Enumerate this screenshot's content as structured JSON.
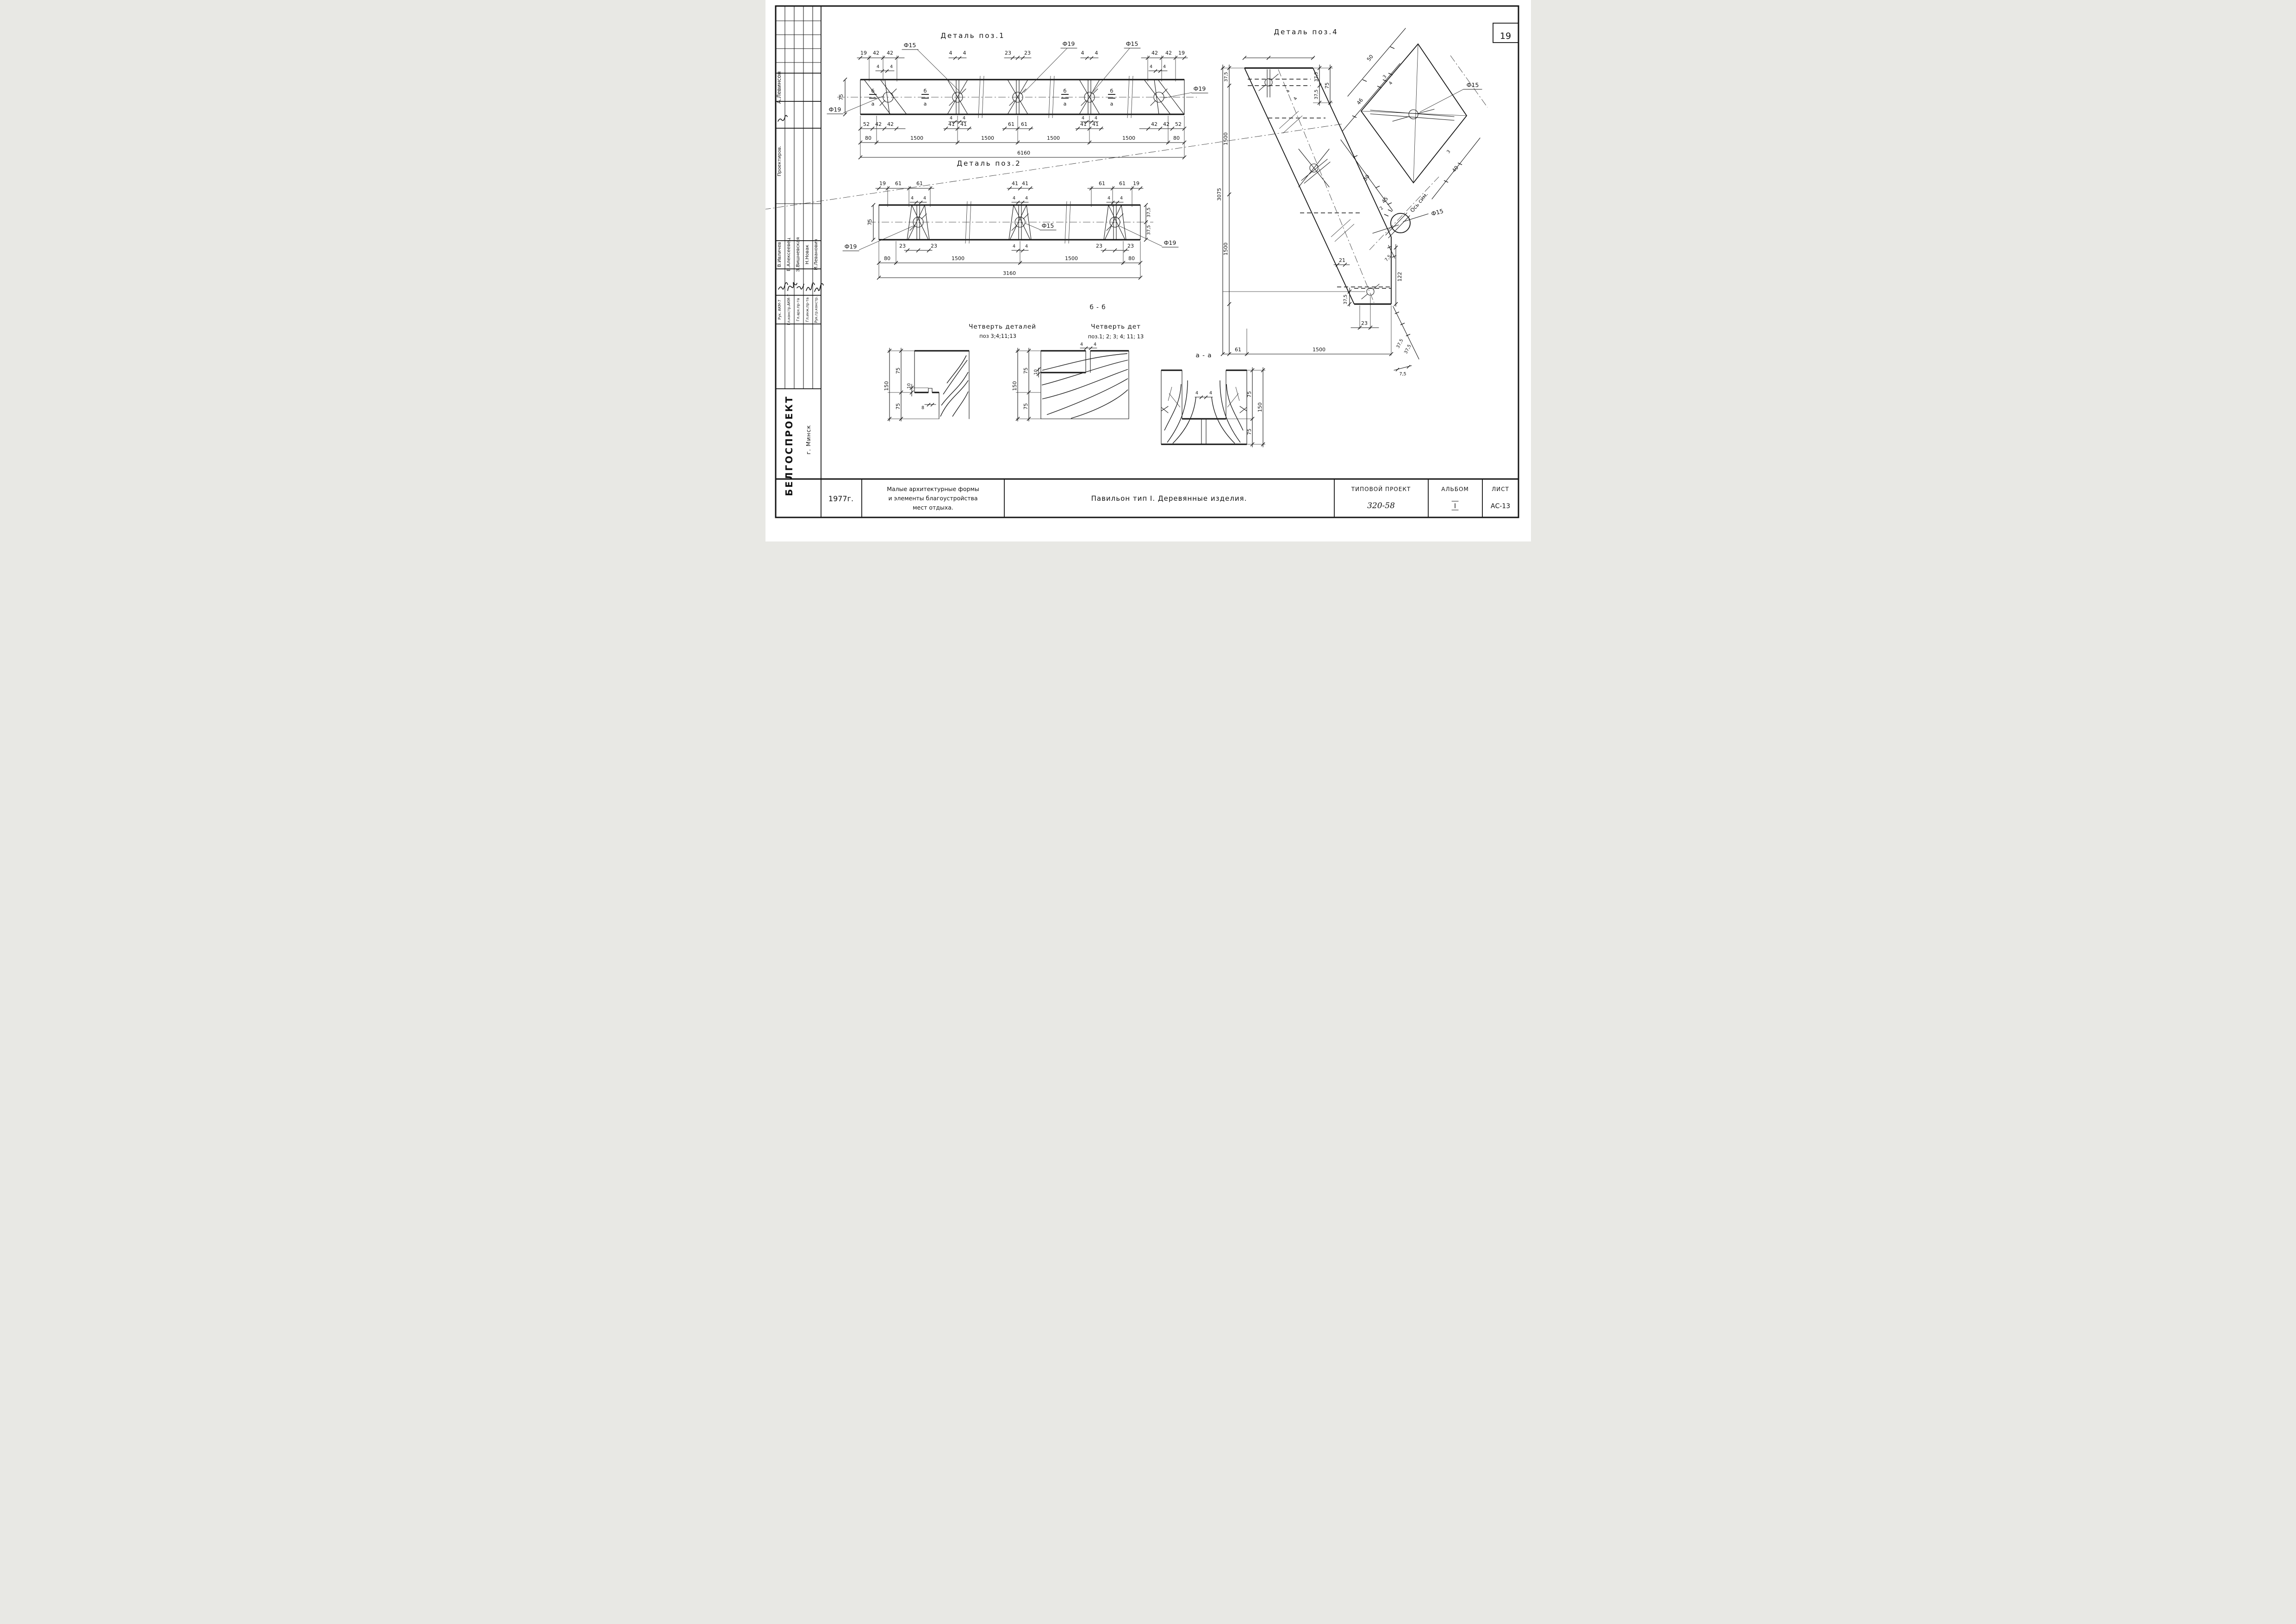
{
  "sheet": {
    "number": "19"
  },
  "titles": {
    "poz1": "Деталь поз.1",
    "poz2": "Деталь поз.2",
    "poz4": "Деталь поз.4",
    "bb": "б - б",
    "aa": "а - а",
    "q1a": "Четверть деталей",
    "q1b": "поз 3;4;11;13",
    "q2a": "Четверть дет",
    "q2b": "поз.1; 2; 3; 4; 11; 13"
  },
  "sidebar": {
    "top": {
      "name": "А.Левинсон",
      "role": "Проектиров."
    },
    "people": [
      {
        "name": "В.Ивличев",
        "role": "Рук. АКМ-7"
      },
      {
        "name": "В.Алексеевец",
        "role": "Гл.констр.АКМ-7"
      },
      {
        "name": "Э.Вишневская",
        "role": "Гл.арх.пр-та"
      },
      {
        "name": "Н.Новак",
        "role": "Гл.инж.пр-та"
      },
      {
        "name": "И.Леванович",
        "role": "Рук.гр.констр."
      }
    ]
  },
  "stamp": {
    "org": "БЕЛГОСПРОЕКТ",
    "city": "г. Минск",
    "year": "1977г.",
    "desc1": "Малые архитектурные формы",
    "desc2": "и элементы благоустройства",
    "desc3": "мест отдыха.",
    "title": "Павильон тип I.  Деревянные изделия.",
    "tp_label": "ТИПОВОЙ ПРОЕКТ",
    "tp_num": "320-58",
    "album_label": "АЛЬБОМ",
    "album_num": "I",
    "sheet_label": "ЛИСТ",
    "sheet_num": "АС-13"
  },
  "dims": {
    "poz1": {
      "tl": [
        "19",
        "42",
        "42"
      ],
      "tl4": [
        "4",
        "4"
      ],
      "b2t": [
        "4",
        "4"
      ],
      "b3t": [
        "23",
        "23"
      ],
      "b4t": [
        "4",
        "4"
      ],
      "tr": [
        "42",
        "42",
        "19"
      ],
      "tr4": [
        "4",
        "4"
      ],
      "b2b4": [
        "4",
        "4"
      ],
      "b4b4": [
        "4",
        "4"
      ],
      "r1l": [
        "52",
        "42",
        "42"
      ],
      "r1b2": [
        "41",
        "41"
      ],
      "r1b3": [
        "61",
        "61"
      ],
      "r1b4": [
        "41",
        "41"
      ],
      "r1r": [
        "42",
        "42",
        "52"
      ],
      "r2": [
        "80",
        "1500",
        "1500",
        "1500",
        "1500",
        "80"
      ],
      "total": "6160",
      "h": "75",
      "phi15a": "Ф15",
      "phi19a": "Ф19",
      "phi15b": "Ф15",
      "phi19bl": "Ф19",
      "phi19r": "Ф19",
      "b": "б",
      "a": "а"
    },
    "poz2": {
      "tl": [
        "19",
        "61",
        "61"
      ],
      "mid": [
        "41",
        "41"
      ],
      "tr": [
        "61",
        "61",
        "19"
      ],
      "s4": [
        "4",
        "4"
      ],
      "h": "75",
      "r375": [
        "37,5",
        "37,5"
      ],
      "b23l": [
        "23",
        "23"
      ],
      "b23r": [
        "23",
        "23"
      ],
      "r2": [
        "80",
        "1500",
        "1500",
        "80"
      ],
      "total": "3160",
      "phi15": "Ф15",
      "phi19bl": "Ф19",
      "phi19r": "Ф19"
    },
    "poz4": {
      "vchain": [
        "37,5",
        "1500",
        "1500"
      ],
      "vtotal": "3075",
      "tr": [
        "37,5",
        "37,5",
        "75"
      ],
      "t4": [
        "4",
        "4"
      ],
      "d122": "122",
      "d375": "37,5",
      "d23": "23",
      "d21": "21",
      "brow": [
        "61",
        "1500"
      ],
      "brot": [
        "37,5",
        "37,5"
      ],
      "d75": "7,5",
      "sq": {
        "d50": "50",
        "d46": "46",
        "d3a": "3",
        "d4a": "4",
        "d3b": "3",
        "d40": "40",
        "d30": "30",
        "d45": "45",
        "phi15": "Ф15"
      },
      "circ": {
        "axis": "Ось сим.",
        "phi15": "Ф15",
        "d2": "2",
        "d75": "7,5"
      }
    },
    "q1": [
      "150",
      "75",
      "10",
      "75",
      "8"
    ],
    "q2": [
      "150",
      "75",
      "10",
      "75",
      "4",
      "4"
    ],
    "aa": [
      "4",
      "4",
      "75",
      "75",
      "150"
    ]
  }
}
